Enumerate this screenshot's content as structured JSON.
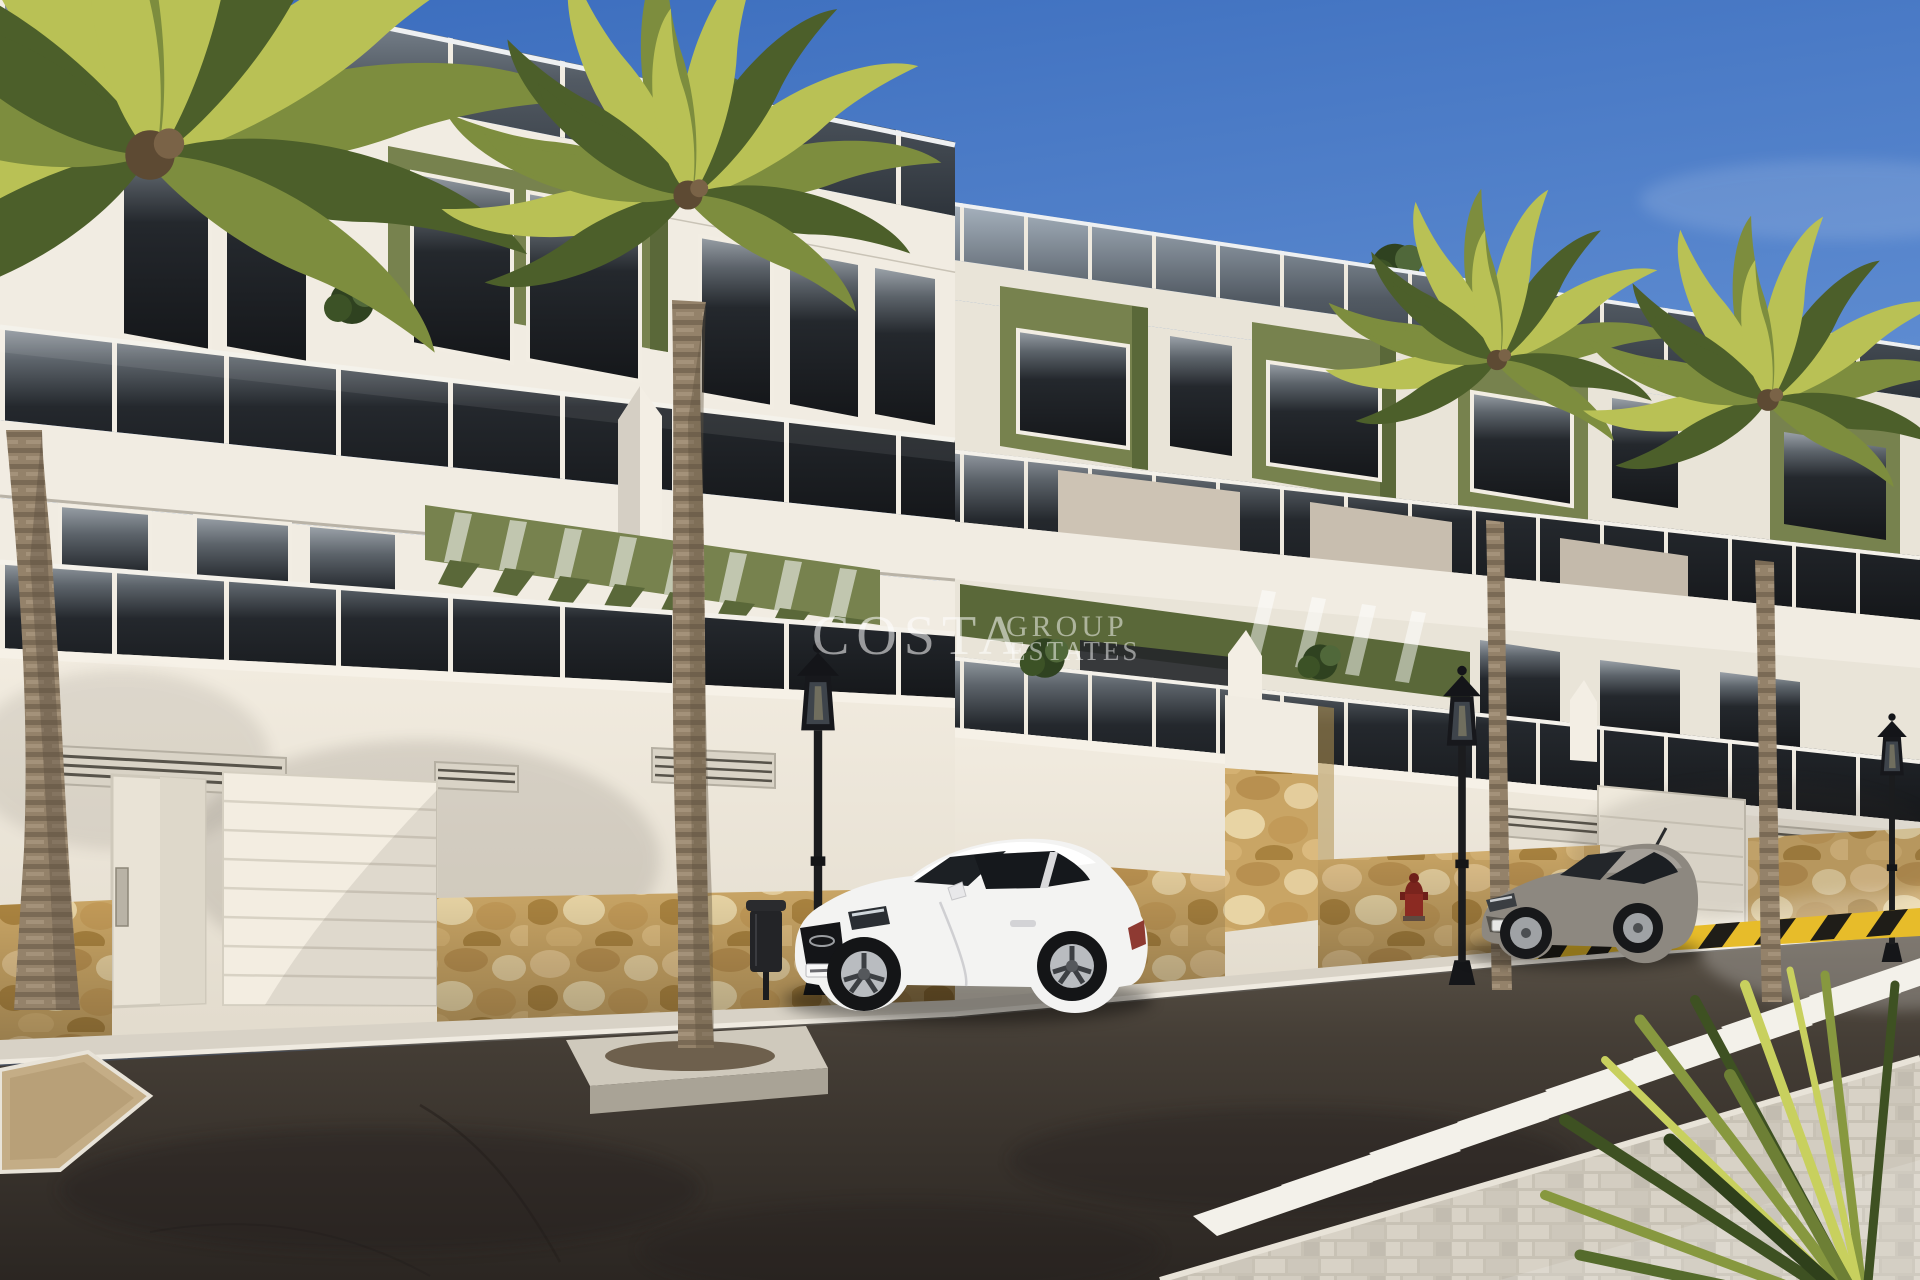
{
  "watermark": {
    "brand": "COSTA",
    "word1": "GROUP",
    "word2": "ESTATES"
  },
  "colors": {
    "sky_top": "#3a6cbd",
    "sky_horizon": "#c2d3ec",
    "wall_white": "#f1ece2",
    "wall_shade": "#e9e4d8",
    "accent_green": "#77824e",
    "accent_green_dark": "#5a6839",
    "glass_dark": "#1d2125",
    "stone": "#c9a565",
    "asphalt": "#453e36",
    "crosswalk": "#f3f1ea",
    "car_white": "#f3f3f2",
    "car_gray": "#8d8880",
    "metal_black": "#1a1b1d",
    "hydrant_red": "#8b2a22",
    "barrier_yellow": "#e7bc2a",
    "palm_light": "#b9c155",
    "palm_green": "#7d8d3e",
    "palm_dark": "#4c5f2a",
    "trunk_brown": "#94826a"
  }
}
